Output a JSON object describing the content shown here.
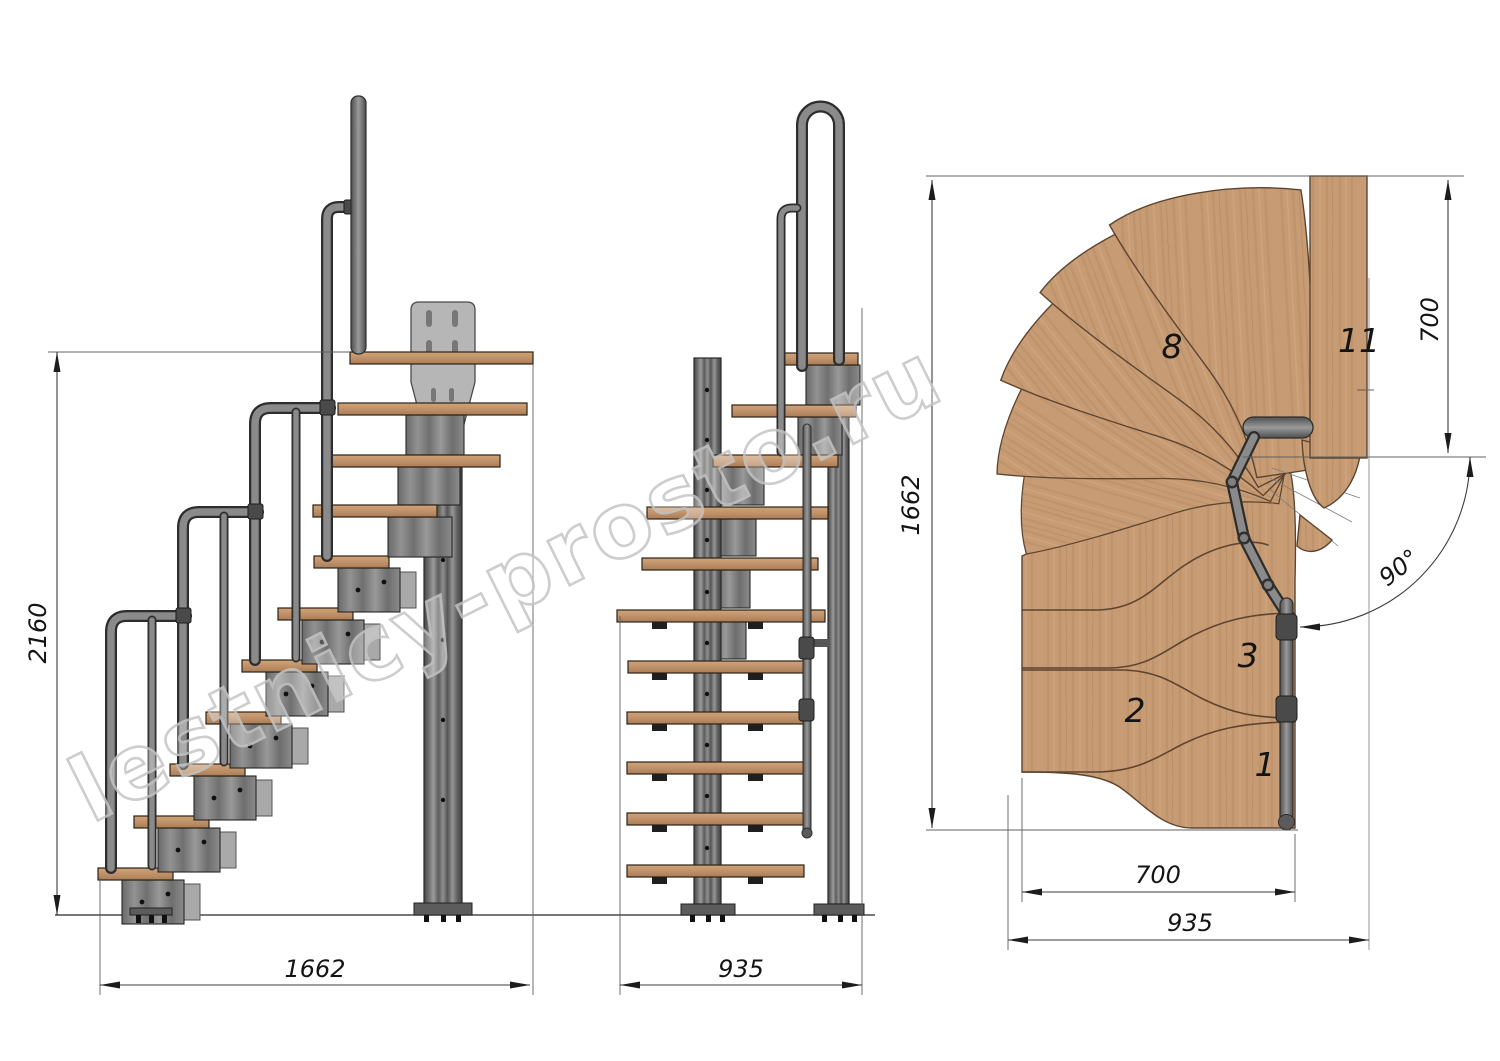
{
  "watermark": {
    "text": "lestnicy-prosto.ru"
  },
  "side_view": {
    "dim_total_height": "2160",
    "dim_total_length": "1662"
  },
  "front_view": {
    "dim_total_width": "935"
  },
  "plan_view": {
    "dim_total_length": "1662",
    "dim_landing_depth": "700",
    "dim_turn_angle": "90°",
    "dim_flight_width": "700",
    "dim_overall_width": "935",
    "tread_labels": {
      "first": "1",
      "second": "2",
      "third": "3",
      "eighth": "8",
      "eleventh": "11"
    }
  },
  "colors": {
    "wood": "#c79c74",
    "wood_edge": "#5d4430",
    "metal": "#8a8a8a",
    "metal_dark": "#3a3a3a",
    "plate": "#b6b6b6",
    "dimension_line": "#3c3c3c",
    "watermark_outline": "#c5c5c5",
    "background": "#ffffff"
  }
}
